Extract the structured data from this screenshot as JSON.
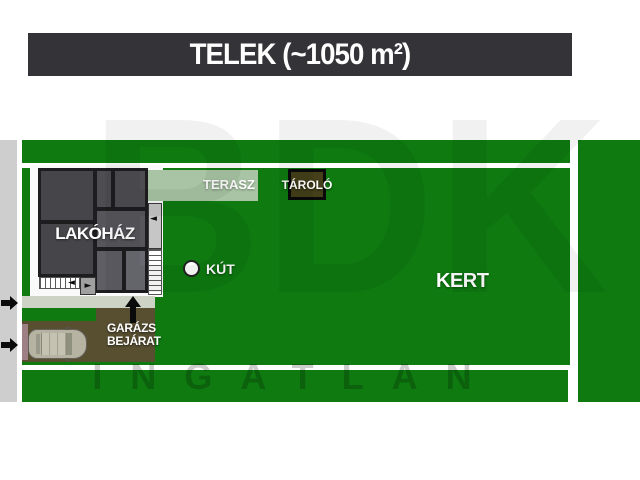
{
  "title": "TELEK (~1050 m²)",
  "labels": {
    "house": "LAKÓHÁZ",
    "terrace": "TERASZ",
    "storage": "TÁROLÓ",
    "well": "KÚT",
    "garden": "KERT",
    "garage_entrance": "GARÁZS\nBEJÁRAT"
  },
  "watermark": {
    "big": "BDK",
    "bottom": "INGATLAN"
  },
  "icons": {
    "road_arrows": "arrow-right-icon",
    "garage_arrow": "arrow-up-icon",
    "well_marker": "well-circle-icon",
    "vehicle": "car-top-view-icon"
  },
  "colors": {
    "title_bar": "#343338",
    "grass": "#0e7a10",
    "road": "#cecece",
    "walkway": "#cdd4c6",
    "terrace": "#a9c4a4",
    "driveway": "#584f31",
    "house_wall": "#1d1d1f",
    "house_fill": "#46464a",
    "storage_fill": "#45401a",
    "label_text": "#ffffff"
  }
}
